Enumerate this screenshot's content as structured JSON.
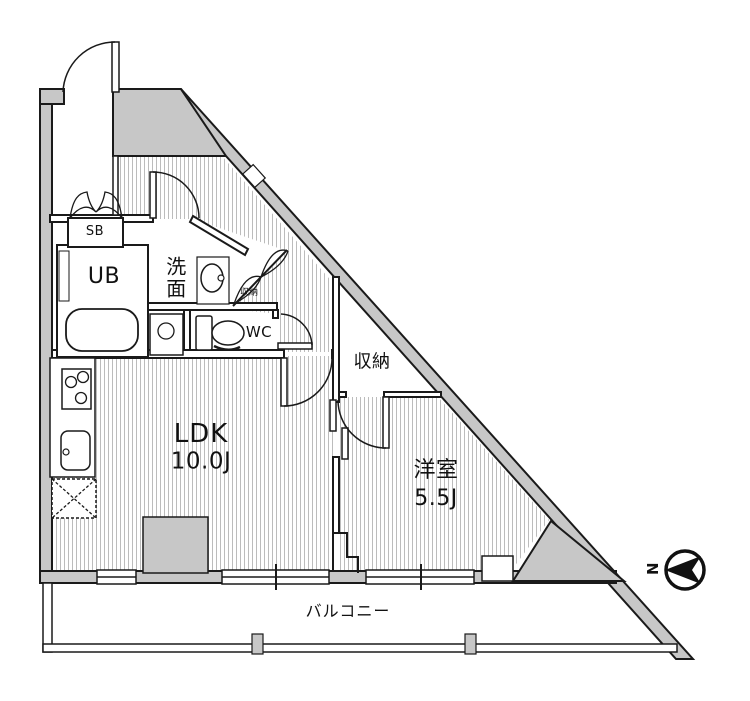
{
  "plan": {
    "rooms": {
      "ldk": {
        "name": "LDK",
        "size": "10.0J"
      },
      "bedroom": {
        "name": "洋室",
        "size": "5.5J"
      },
      "unit_bath": {
        "label": "UB"
      },
      "washroom": {
        "label": "洗面"
      },
      "toilet": {
        "label": "WC"
      },
      "shoe_box": {
        "label": "SB"
      },
      "hall_closet": {
        "label": "収納"
      },
      "bedroom_closet": {
        "label": "収納"
      },
      "balcony": {
        "label": "バルコニー"
      }
    },
    "compass": {
      "north_label": "N"
    },
    "colors": {
      "wall_fill": "#c7c7c7",
      "line": "#1a1a1a",
      "hatch_line": "#bcbcbc",
      "background": "#ffffff"
    }
  }
}
